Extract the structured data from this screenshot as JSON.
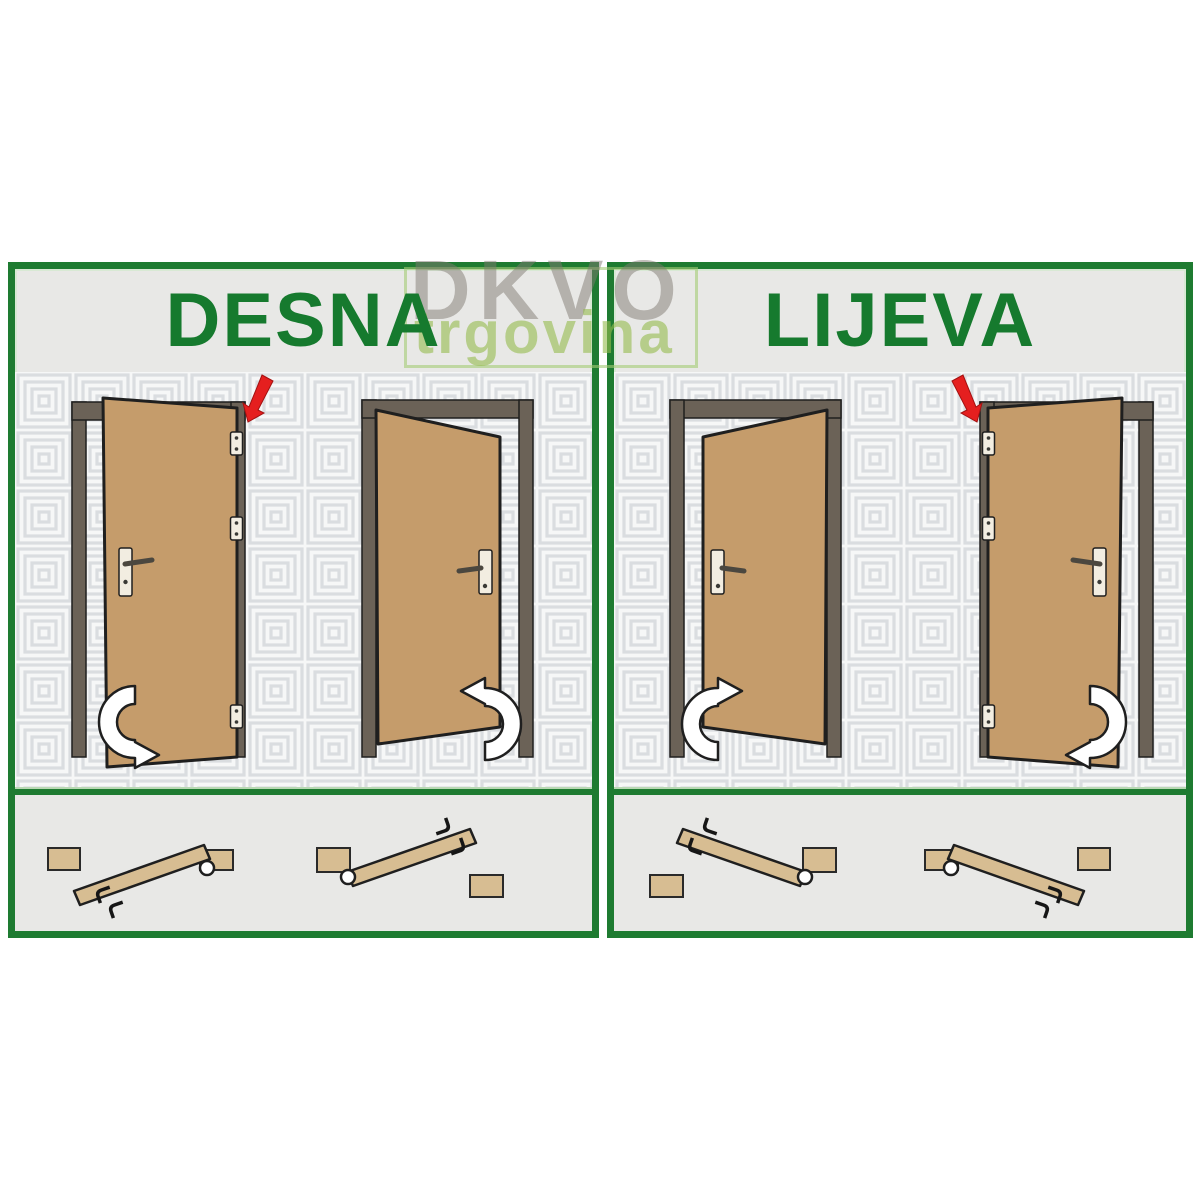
{
  "watermark": {
    "line1": "DKVO",
    "line2": "trgovina"
  },
  "panels": [
    {
      "id": "desna",
      "title": "DESNA"
    },
    {
      "id": "lijeva",
      "title": "LIJEVA"
    }
  ],
  "colors": {
    "panel_border_green": "#1e7b31",
    "title_green": "#167a2e",
    "door_tan": "#c59c6b",
    "door_frame_gray": "#6b6257",
    "wall_background": "#f6f7f7",
    "wall_pattern_line": "#dadde0",
    "header_footer_gray": "#e8e8e6",
    "hinge_pointer_red": "#e51f1f",
    "plan_wood_tan": "#d7bd92",
    "watermark_gray": "#a8a39d",
    "watermark_green": "#bcd88f"
  },
  "icons": {
    "hinge_pointer": "red-down-arrow",
    "swing_direction": "white-curved-arrow",
    "hinge": "hinge-plate",
    "handle": "lever-handle",
    "pivot": "hinge-pivot-circle",
    "hook": "hinge-hook"
  }
}
